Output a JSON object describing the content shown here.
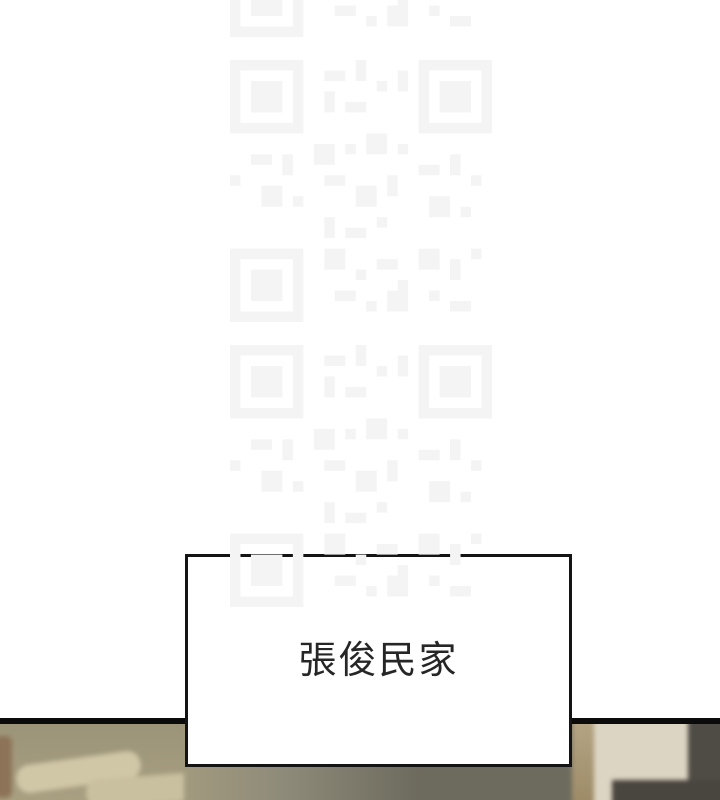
{
  "scene": {
    "type": "comic-page-segment",
    "caption_box": {
      "label": "張俊民家"
    },
    "watermark_icon": "qr-watermark"
  },
  "css_vars": {
    "page-bg": "#ffffff",
    "ink": "#0b0b0b",
    "caption-border": "#141414",
    "caption-text": "#262626",
    "watermark": "#f4f4f4",
    "bed-khaki": "#a9a082",
    "bed-dark": "#9b9378",
    "pillow-beige": "#d0c7a7",
    "pillow2-beige": "#c9c09f",
    "left-brown": "#8d7458",
    "floor-khaki": "#a29a7e",
    "floor-light": "#8f8b7a",
    "floor-olive": "#6d6b5e",
    "pillar-tan": "#9c8a66",
    "pillar-tan-light": "#b5a585",
    "wall-beige": "#ddd5c3",
    "chair-dark": "#4f4b45",
    "shadow-dark": "#49453f"
  }
}
